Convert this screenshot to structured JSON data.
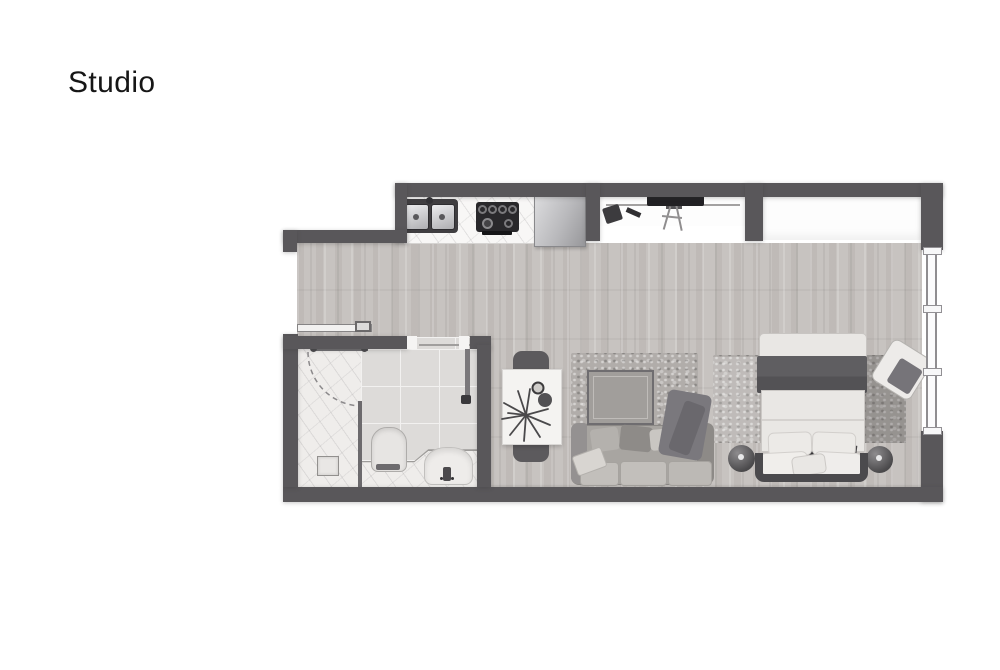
{
  "title": {
    "label": "Studio"
  },
  "palette": {
    "page_bg": "#ffffff",
    "title_color": "#161616",
    "wall": "#59575a",
    "floor": "#c7c3c0",
    "tile": "#dddbd9",
    "tile_grout": "#f2f1f0",
    "marble": "#efedeb",
    "counter": "#f8f7f6",
    "rug": "#b1adaa",
    "sofa": "#a8a5a1",
    "duvet": "#e9e7e4",
    "blanket": "#5f5e61",
    "headboard": "#4b4a4d",
    "furniture_dark": "#5c5a5d"
  }
}
